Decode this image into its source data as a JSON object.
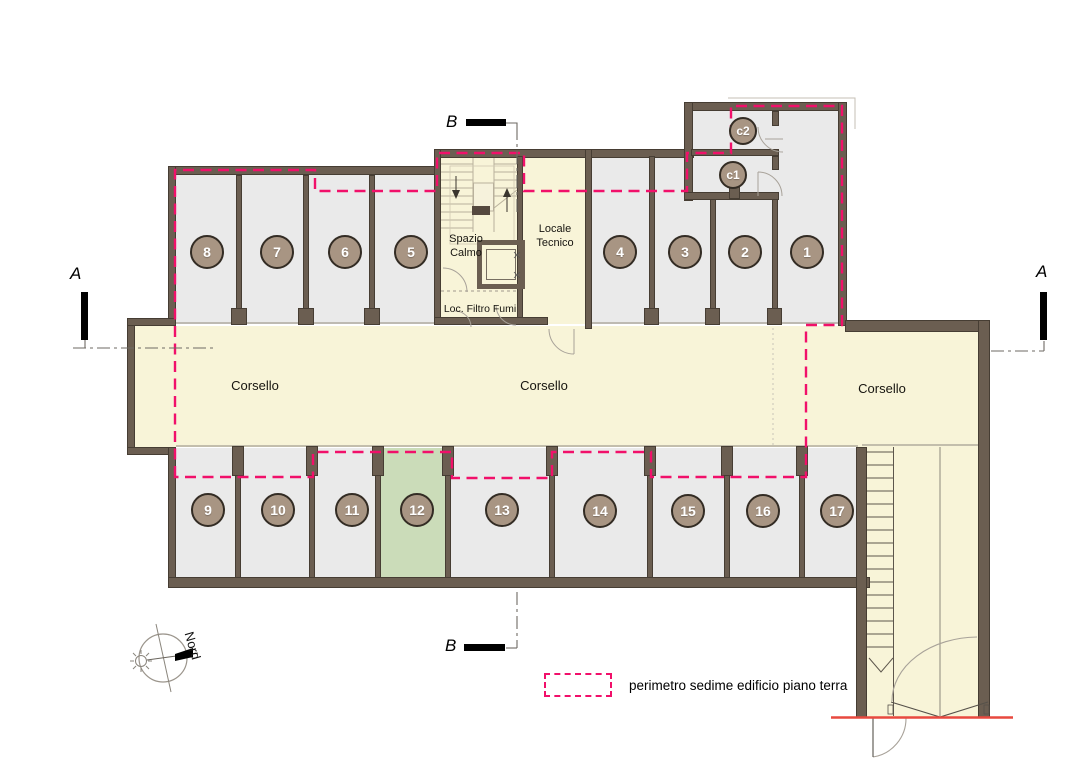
{
  "colors": {
    "perimeter_dash": "#f1106a",
    "wall": "#6b5e51",
    "unit_fill": "#eaeaea",
    "corridor_fill": "#f8f4d8",
    "highlight_unit_fill": "#cbdcb9",
    "badge_fill": "#a89583",
    "threshold_red": "#e8493f"
  },
  "units": {
    "u1": "1",
    "u2": "2",
    "u3": "3",
    "u4": "4",
    "u5": "5",
    "u6": "6",
    "u7": "7",
    "u8": "8",
    "u9": "9",
    "u10": "10",
    "u11": "11",
    "u12": "12",
    "u13": "13",
    "u14": "14",
    "u15": "15",
    "u16": "16",
    "u17": "17",
    "c1": "c1",
    "c2": "c2"
  },
  "rooms": {
    "corsello_left": "Corsello",
    "corsello_center": "Corsello",
    "corsello_right": "Corsello",
    "spazio_calmo": "Spazio Calmo",
    "locale_tecnico": "Locale Tecnico",
    "loc_filtro_fumi": "Loc. Filtro Fumi"
  },
  "section_markers": {
    "a": "A",
    "b": "B"
  },
  "compass": {
    "label": "Nord"
  },
  "legend": {
    "label": "perimetro sedime edificio piano terra"
  }
}
